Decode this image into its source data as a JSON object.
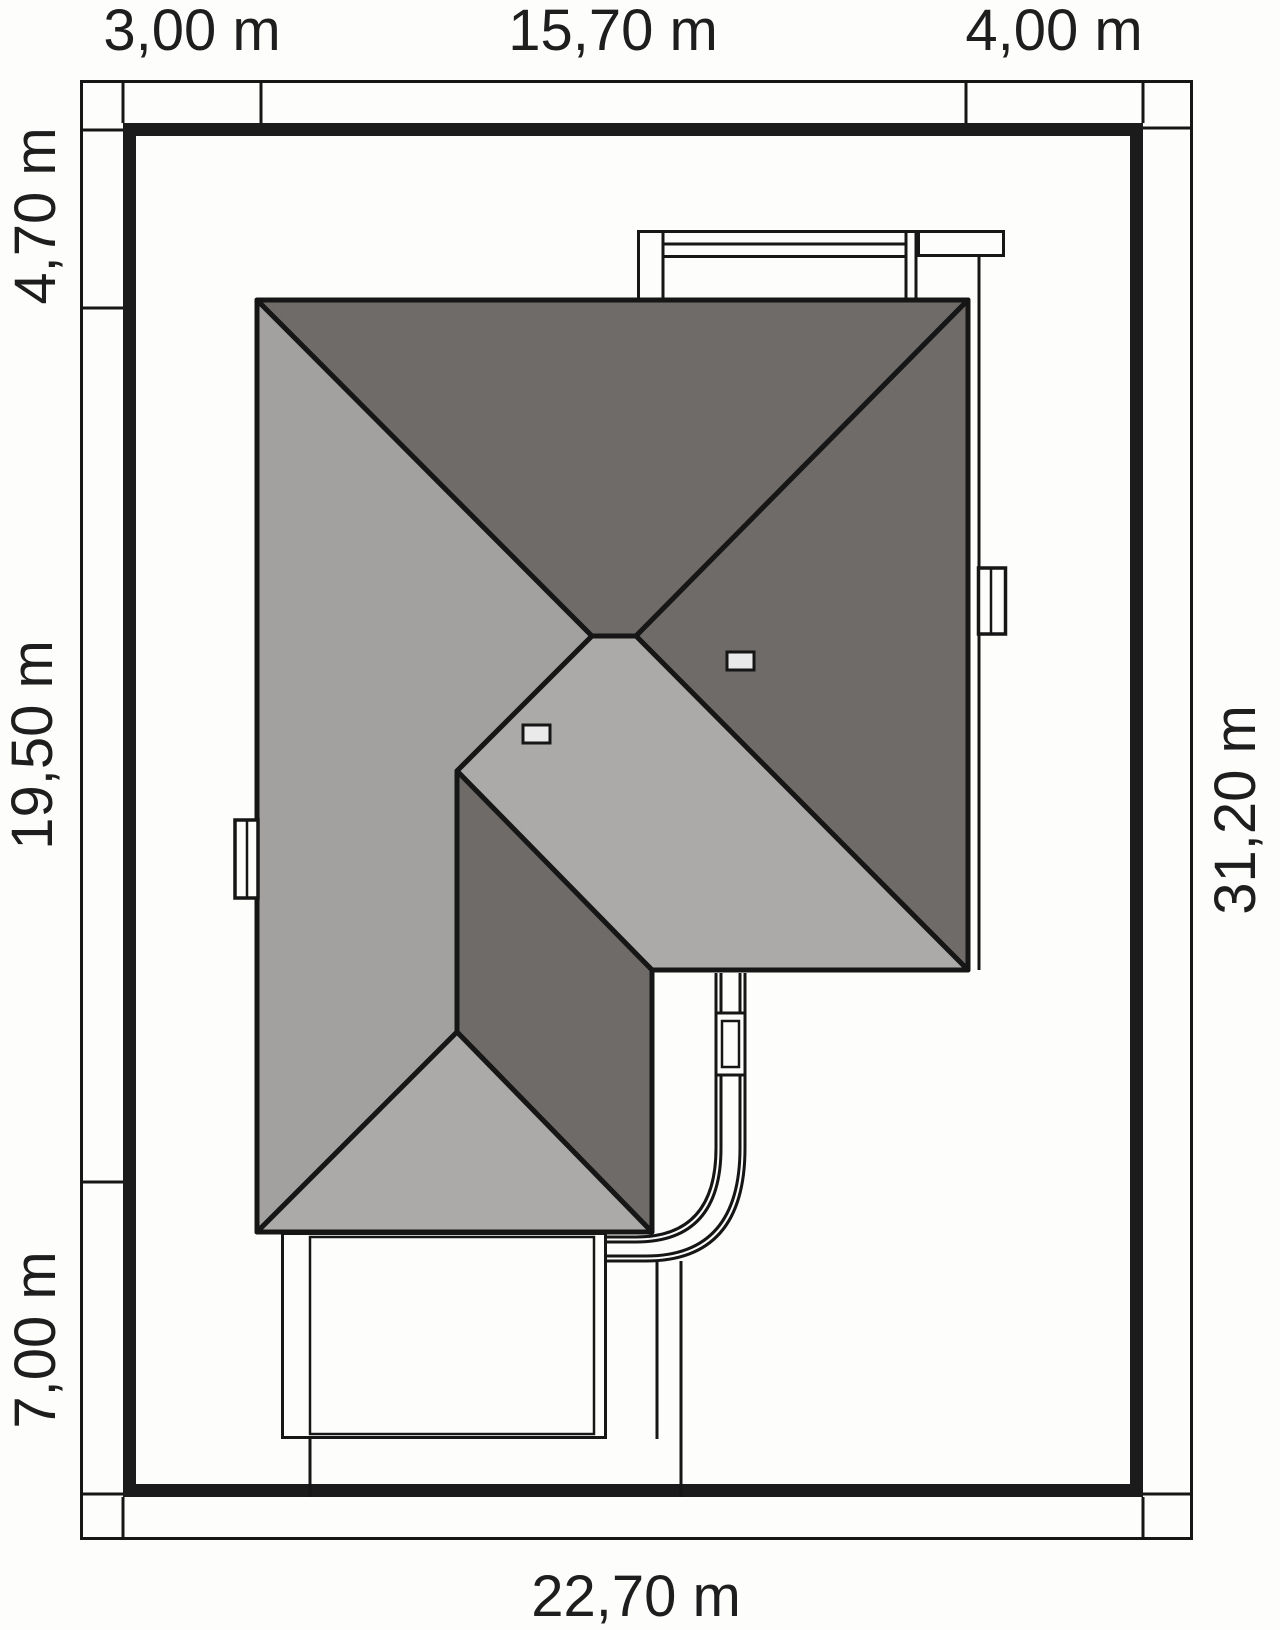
{
  "drawing": {
    "type": "architectural site plan (roof plan on plot)",
    "units": "m"
  },
  "colors": {
    "line": "#161616",
    "thick_border": "#1b1b1b",
    "dark_roof": "#6f6b68",
    "light_roof": "#a2a19f",
    "lighter_roof": "#abaaa8",
    "skylight": "#eaeaea",
    "white": "#fdfdfc",
    "label": "#1e1e1e"
  },
  "dims": {
    "top": [
      {
        "text": "3,00 m"
      },
      {
        "text": "15,70 m"
      },
      {
        "text": "4,00 m"
      }
    ],
    "left": [
      {
        "text": "4,70 m"
      },
      {
        "text": "19,50 m"
      },
      {
        "text": "7,00 m"
      }
    ],
    "right": [
      {
        "text": "31,20 m"
      }
    ],
    "bottom": [
      {
        "text": "22,70 m"
      }
    ]
  },
  "plot": {
    "width_m": "22,70",
    "height_m": "31,20",
    "top_segments_m": [
      "3,00",
      "15,70",
      "4,00"
    ],
    "left_segments_m": [
      "4,70",
      "19,50",
      "7,00"
    ]
  }
}
